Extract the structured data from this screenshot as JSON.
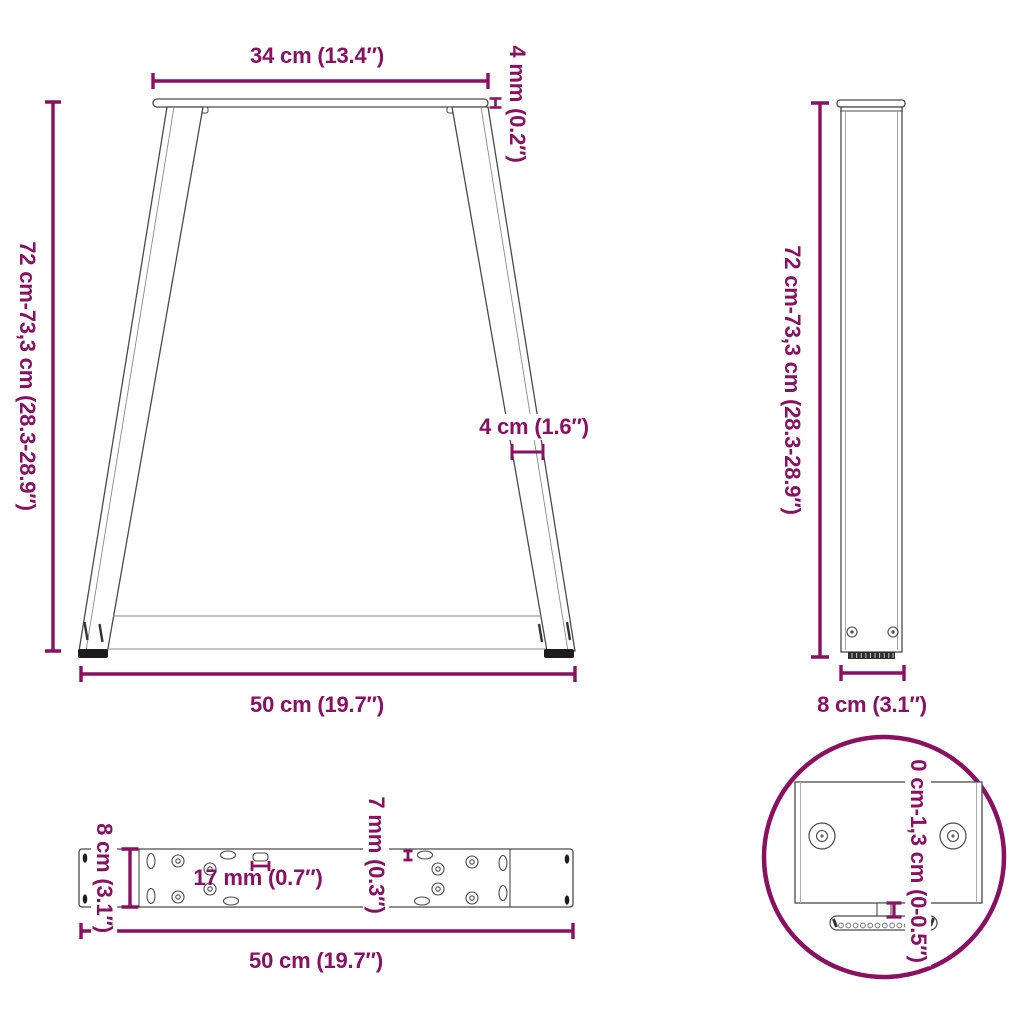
{
  "image_type": "product dimension diagram",
  "subject": "V-shaped table legs with mounting plate and adjustable feet",
  "colors": {
    "dimension_accent": "#8A1062",
    "drawing_outline": "#4a4a4a",
    "feet_dark": "#1d1d1d",
    "background": "#ffffff"
  },
  "views": {
    "front": {
      "top_width": "34 cm (13.4″)",
      "plate_thickness": "4 mm (0.2″)",
      "height_range": "72 cm-73,3 cm (28.3-28.9″)",
      "leg_profile_width": "4 cm (1.6″)",
      "bottom_width": "50 cm (19.7″)"
    },
    "side": {
      "height_range": "72 cm-73,3 cm (28.3-28.9″)",
      "depth": "8 cm (3.1″)"
    },
    "plate_top": {
      "depth": "8 cm (3.1″)",
      "slot_length": "17 mm (0.7″)",
      "slot_width": "7 mm (0.3″)",
      "length": "50 cm (19.7″)"
    },
    "foot_detail": {
      "adjustment_range": "0 cm-1,3 cm (0-0.5″)"
    }
  }
}
